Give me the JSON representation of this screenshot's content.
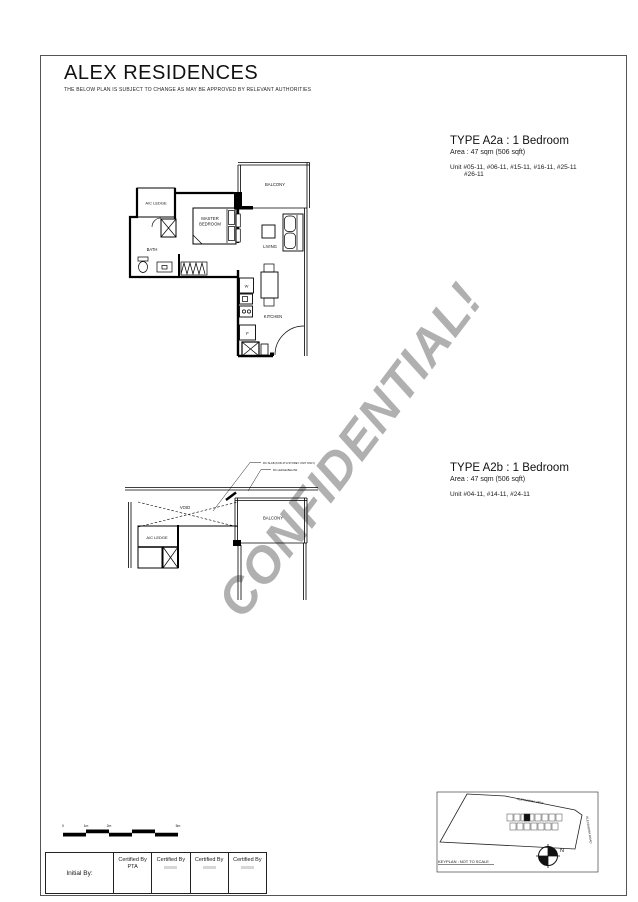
{
  "header": {
    "title": "ALEX RESIDENCES",
    "disclaimer": "THE BELOW PLAN IS SUBJECT TO CHANGE AS MAY BE APPROVED BY RELEVANT AUTHORITIES"
  },
  "watermark": "CONFIDENTIAL!",
  "type_a2a": {
    "title": "TYPE A2a : 1 Bedroom",
    "area": "Area : 47 sqm (506 sqft)",
    "unit_line1": "Unit  #05-11, #06-11, #15-11, #16-11, #25-11",
    "unit_line2": "#26-11"
  },
  "type_a2b": {
    "title": "TYPE A2b : 1 Bedroom",
    "area": "Area : 47 sqm (506 sqft)",
    "unit_line1": "Unit  #04-11, #14-11, #24-11"
  },
  "plan_a2a": {
    "balcony": "BALCONY",
    "ac_ledge": "A/C LEDGE",
    "master_line1": "MASTER",
    "master_line2": "BEDROOM",
    "bath": "BATH",
    "living": "LIVING",
    "kitchen": "KITCHEN",
    "washer": "W",
    "fridge": "F"
  },
  "plan_a2b": {
    "void": "VOID",
    "ac_ledge": "A/C LEDGE",
    "balcony": "BALCONY",
    "note1": "RC SLAB (FOR 4TH STOREY UNIT ONLY)",
    "note2": "RC LEDGE BELOW"
  },
  "scale_bar": {
    "t0": "0",
    "t1": "1m",
    "t2": "2m",
    "t5": "5m"
  },
  "initials": {
    "label": "Initial By:",
    "cert1_line1": "Certified By",
    "cert1_line2": "PTA",
    "cert2": "Certified By",
    "cert3": "Certified By",
    "cert4": "Certified By"
  },
  "keyplan": {
    "street_top": "ALEXANDRA VIEW",
    "street_right": "ALEXANDRA ROAD",
    "caption": "KEYPLAN : NOT TO SCALE",
    "north": "N"
  }
}
